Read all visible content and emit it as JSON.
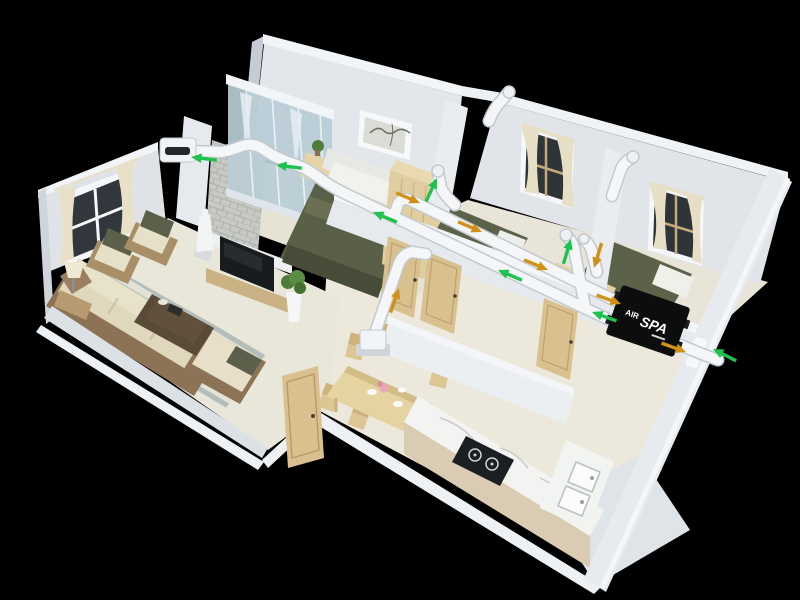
{
  "scene": {
    "background": "#000000"
  },
  "unit": {
    "label_air": "AIR",
    "label_spa": "SPA"
  },
  "colors": {
    "supply": "#1fc24f",
    "exhaust": "#d19117",
    "duct": "#f4f6f8",
    "duct_outline": "#c3c9cf",
    "unit_body": "#0c0d0d",
    "unit_text": "#ffffff"
  },
  "airflow": {
    "arrows": [
      {
        "type": "supply",
        "x": 191,
        "y": 157,
        "rot": 187
      },
      {
        "type": "supply",
        "x": 276,
        "y": 165,
        "rot": 187
      },
      {
        "type": "supply",
        "x": 373,
        "y": 212,
        "rot": 203
      },
      {
        "type": "supply",
        "x": 498,
        "y": 270,
        "rot": 203
      },
      {
        "type": "supply",
        "x": 437,
        "y": 178,
        "rot": 295
      },
      {
        "type": "supply",
        "x": 571,
        "y": 239,
        "rot": 287
      },
      {
        "type": "supply",
        "x": 592,
        "y": 312,
        "rot": 200
      },
      {
        "type": "supply",
        "x": 713,
        "y": 349,
        "rot": 207
      },
      {
        "type": "exhaust",
        "x": 420,
        "y": 203,
        "rot": 23
      },
      {
        "type": "exhaust",
        "x": 482,
        "y": 232,
        "rot": 23
      },
      {
        "type": "exhaust",
        "x": 548,
        "y": 270,
        "rot": 23
      },
      {
        "type": "exhaust",
        "x": 594,
        "y": 268,
        "rot": 107
      },
      {
        "type": "exhaust",
        "x": 621,
        "y": 304,
        "rot": 20
      },
      {
        "type": "exhaust",
        "x": 686,
        "y": 352,
        "rot": 20
      },
      {
        "type": "exhaust",
        "x": 399,
        "y": 288,
        "rot": 289
      }
    ]
  }
}
